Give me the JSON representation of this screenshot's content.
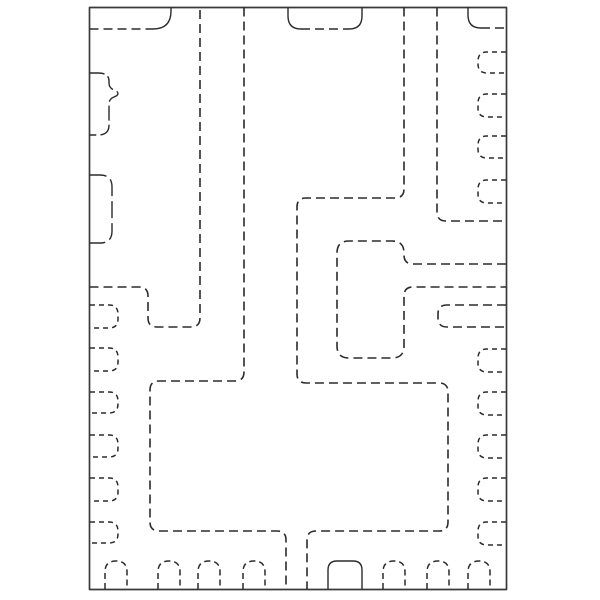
{
  "meta": {
    "description": "Mechanical outline drawing of a QFN/SON-style IC package (bottom-pad land pattern view). Hidden pad regions drawn dashed; package-body features drawn solid. No text appears in the image.",
    "background_color": "#ffffff",
    "line_color": "#2b2b2b",
    "border_color": "#3a3a3a"
  },
  "drawing": {
    "width": 600,
    "height": 600,
    "viewbox": "0 0 600 600",
    "paths": [
      {
        "name": "package-outer-border",
        "d": "M 89.5 7.5 H 506.5 V 589.5 H 89.5 Z",
        "dash": null,
        "width": 1.7
      },
      {
        "name": "top-left-pad-bottom-edge",
        "d": "M 89.5 29 H 153",
        "dash": "9 5",
        "width": 1.6
      },
      {
        "name": "top-left-pad-corner-curve",
        "d": "M 153 29 Q 171 29 171 11 L 171 7.5",
        "dash": null,
        "width": 1.4
      },
      {
        "name": "top-notch-side-walls",
        "d": "M 288 7.5 V 16 Q 288 29 301 29 M 362 7.5 V 16 Q 362 29 349 29",
        "dash": null,
        "width": 1.4
      },
      {
        "name": "top-notch-bottom-edge",
        "d": "M 301 29 H 349",
        "dash": "9 5",
        "width": 1.6
      },
      {
        "name": "top-right-corner-curve",
        "d": "M 468 7.5 V 15 Q 468 28 481 28",
        "dash": null,
        "width": 1.4
      },
      {
        "name": "top-right-corner-bottom-edge",
        "d": "M 481 28 H 506",
        "dash": "9 5",
        "width": 1.6
      },
      {
        "name": "left-bump-lead",
        "d": "M 89.5 73 H 98 Q 109 73 109 81 V 83 Q 109 88 114 90 Q 118 91.5 118 93.5 Q 118 95.5 114 97 Q 109 99 109 104 V 125 Q 109 135 98 135 H 89.5",
        "dash": "15 4",
        "width": 1.4
      },
      {
        "name": "left-rounded-lead",
        "d": "M 89.5 175 H 100 Q 112 175 112 187 V 231 Q 112 243 100 243 H 89.5",
        "dash": "17 5",
        "width": 1.4
      },
      {
        "name": "left-region-boundary",
        "d": "M 89.5 287 H 139 Q 148 287 148 296 V 318 Q 148 327 157 327 H 191 Q 200 327 200 318 V 7.5",
        "dash": "9 5",
        "width": 1.6
      },
      {
        "name": "center-left-region-boundary",
        "d": "M 244 7.5 V 372 Q 244 381 235 381 H 159 Q 150 381 150 390 V 522 Q 150 531 159 531 H 277 Q 286 531 286 540 V 589",
        "dash": "9 5",
        "width": 1.6
      },
      {
        "name": "center-right-region-boundary",
        "d": "M 404 7.5 V 189 Q 404 198 395 198 H 306 Q 297 198 297 207 V 374 Q 297 383 306 383 H 439 Q 448 383 448 392 V 522 Q 448 531 439 531 H 316 Q 307 531 307 540 V 589",
        "dash": "9 5",
        "width": 1.6
      },
      {
        "name": "top-right-region-boundary",
        "d": "M 437 7.5 V 212 Q 437 221 446 221 H 506",
        "dash": "9 5",
        "width": 1.6
      },
      {
        "name": "center-pad-with-right-arm",
        "d": "M 506 264 H 413 Q 404 264 404 255 V 253 Q 404 241 392 241 H 349 Q 337 241 337 253 V 346 Q 337 358 349 358 H 392 Q 404 358 404 346 V 296 Q 404 287 413 287 H 506",
        "dash": "9 5",
        "width": 1.6
      },
      {
        "name": "right-stadium-bar-pad",
        "d": "M 506 305 H 447 Q 438 305 438 314 V 318 Q 438 327 447 327 H 506",
        "dash": "9 5",
        "width": 1.6
      },
      {
        "name": "bottom-wide-notch",
        "d": "M 328 589 V 570 Q 328 561 337 561 H 353 Q 362 561 362 570 V 589",
        "dash": null,
        "width": 1.4
      },
      {
        "name": "right-edge-pad-1",
        "d": "M 506 52 H 487 Q 478 52 478 61 V 64 Q 478 73 487 73 H 506",
        "dash": "5 4",
        "width": 1.5
      },
      {
        "name": "right-edge-pad-2",
        "d": "M 506 94 H 487 Q 478 94 478 103 V 108 Q 478 117 487 117 H 506",
        "dash": "5 4",
        "width": 1.5
      },
      {
        "name": "right-edge-pad-3",
        "d": "M 506 136 H 487 Q 478 136 478 145 V 149 Q 478 158 487 158 H 506",
        "dash": "5 4",
        "width": 1.5
      },
      {
        "name": "right-edge-pad-4",
        "d": "M 506 180 H 487 Q 478 180 478 189 V 194 Q 478 203 487 203 H 506",
        "dash": "5 4",
        "width": 1.5
      },
      {
        "name": "right-edge-pad-5",
        "d": "M 506 349 H 487 Q 478 349 478 358 V 363 Q 478 372 487 372 H 506",
        "dash": "5 4",
        "width": 1.5
      },
      {
        "name": "right-edge-pad-6",
        "d": "M 506 392 H 487 Q 478 392 478 401 V 406 Q 478 415 487 415 H 506",
        "dash": "5 4",
        "width": 1.5
      },
      {
        "name": "right-edge-pad-7",
        "d": "M 506 435 H 487 Q 478 435 478 444 V 449 Q 478 458 487 458 H 506",
        "dash": "5 4",
        "width": 1.5
      },
      {
        "name": "right-edge-pad-8",
        "d": "M 506 478 H 487 Q 478 478 478 487 V 492 Q 478 501 487 501 H 506",
        "dash": "5 4",
        "width": 1.5
      },
      {
        "name": "right-edge-pad-9",
        "d": "M 506 522 H 487 Q 478 522 478 531 V 536 Q 478 545 487 545 H 506",
        "dash": "5 4",
        "width": 1.5
      },
      {
        "name": "left-edge-pad-1",
        "d": "M 90 305 H 109 Q 118 305 118 314 V 319 Q 118 328 109 328 H 90",
        "dash": "5 4",
        "width": 1.5
      },
      {
        "name": "left-edge-pad-2",
        "d": "M 90 348 H 109 Q 118 348 118 357 V 362 Q 118 371 109 371 H 90",
        "dash": "5 4",
        "width": 1.5
      },
      {
        "name": "left-edge-pad-3",
        "d": "M 90 392 H 109 Q 118 392 118 401 V 404 Q 118 413 109 413 H 90",
        "dash": "5 4",
        "width": 1.5
      },
      {
        "name": "left-edge-pad-4",
        "d": "M 90 435 H 109 Q 118 435 118 444 V 448 Q 118 457 109 457 H 90",
        "dash": "5 4",
        "width": 1.5
      },
      {
        "name": "left-edge-pad-5",
        "d": "M 90 478 H 109 Q 118 478 118 487 V 492 Q 118 501 109 501 H 90",
        "dash": "5 4",
        "width": 1.5
      },
      {
        "name": "left-edge-pad-6",
        "d": "M 90 522 H 109 Q 118 522 118 531 V 534 Q 118 543 109 543 H 90",
        "dash": "5 4",
        "width": 1.5
      },
      {
        "name": "bottom-edge-pad-1",
        "d": "M 105 589 V 572 Q 105 561 116 561 Q 127 561 127 572 V 589",
        "dash": "6 4",
        "width": 1.5
      },
      {
        "name": "bottom-edge-pad-2",
        "d": "M 158 589 V 572 Q 158 561 169 561 Q 180 561 180 572 V 589",
        "dash": "6 4",
        "width": 1.5
      },
      {
        "name": "bottom-edge-pad-3",
        "d": "M 198 589 V 572 Q 198 561 209 561 Q 220 561 220 572 V 589",
        "dash": "6 4",
        "width": 1.5
      },
      {
        "name": "bottom-edge-pad-4",
        "d": "M 243 589 V 572 Q 243 561 254 561 Q 265 561 265 572 V 589",
        "dash": "6 4",
        "width": 1.5
      },
      {
        "name": "bottom-edge-pad-5",
        "d": "M 383 589 V 572 Q 383 561 394 561 Q 405 561 405 572 V 589",
        "dash": "6 4",
        "width": 1.5
      },
      {
        "name": "bottom-edge-pad-6",
        "d": "M 427 589 V 572 Q 427 561 438 561 Q 449 561 449 572 V 589",
        "dash": "6 4",
        "width": 1.5
      },
      {
        "name": "bottom-edge-pad-7",
        "d": "M 468 589 V 572 Q 468 561 479 561 Q 490 561 490 572 V 589",
        "dash": "6 4",
        "width": 1.5
      }
    ]
  }
}
